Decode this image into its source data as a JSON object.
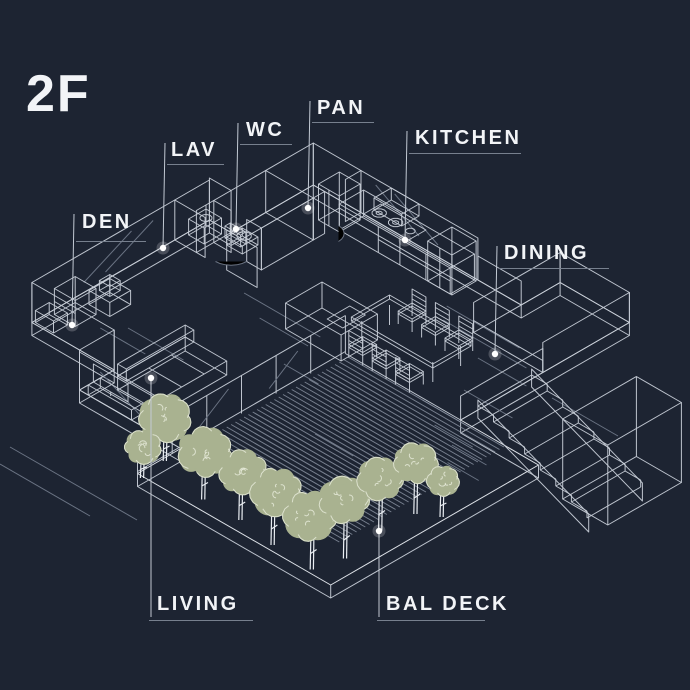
{
  "title": "2F",
  "labels": {
    "den": "DEN",
    "lav": "LAV",
    "wc": "WC",
    "pan": "PAN",
    "kitchen": "KITCHEN",
    "dining": "DINING",
    "living": "LIVING",
    "bal_deck": "BAL DECK"
  },
  "colors": {
    "background": "#1d2432",
    "line": "#c7cdd7",
    "line_bright": "#e9edf2",
    "line_dim": "#6a7383",
    "hatch": "#9099a8",
    "leader": "#c2c9d3",
    "foliage": "#a9b290",
    "foliage_detail": "#e8ecdc",
    "label_text": "#f2f4f7",
    "label_underline": "#77808e",
    "dot": "#ffffff"
  }
}
